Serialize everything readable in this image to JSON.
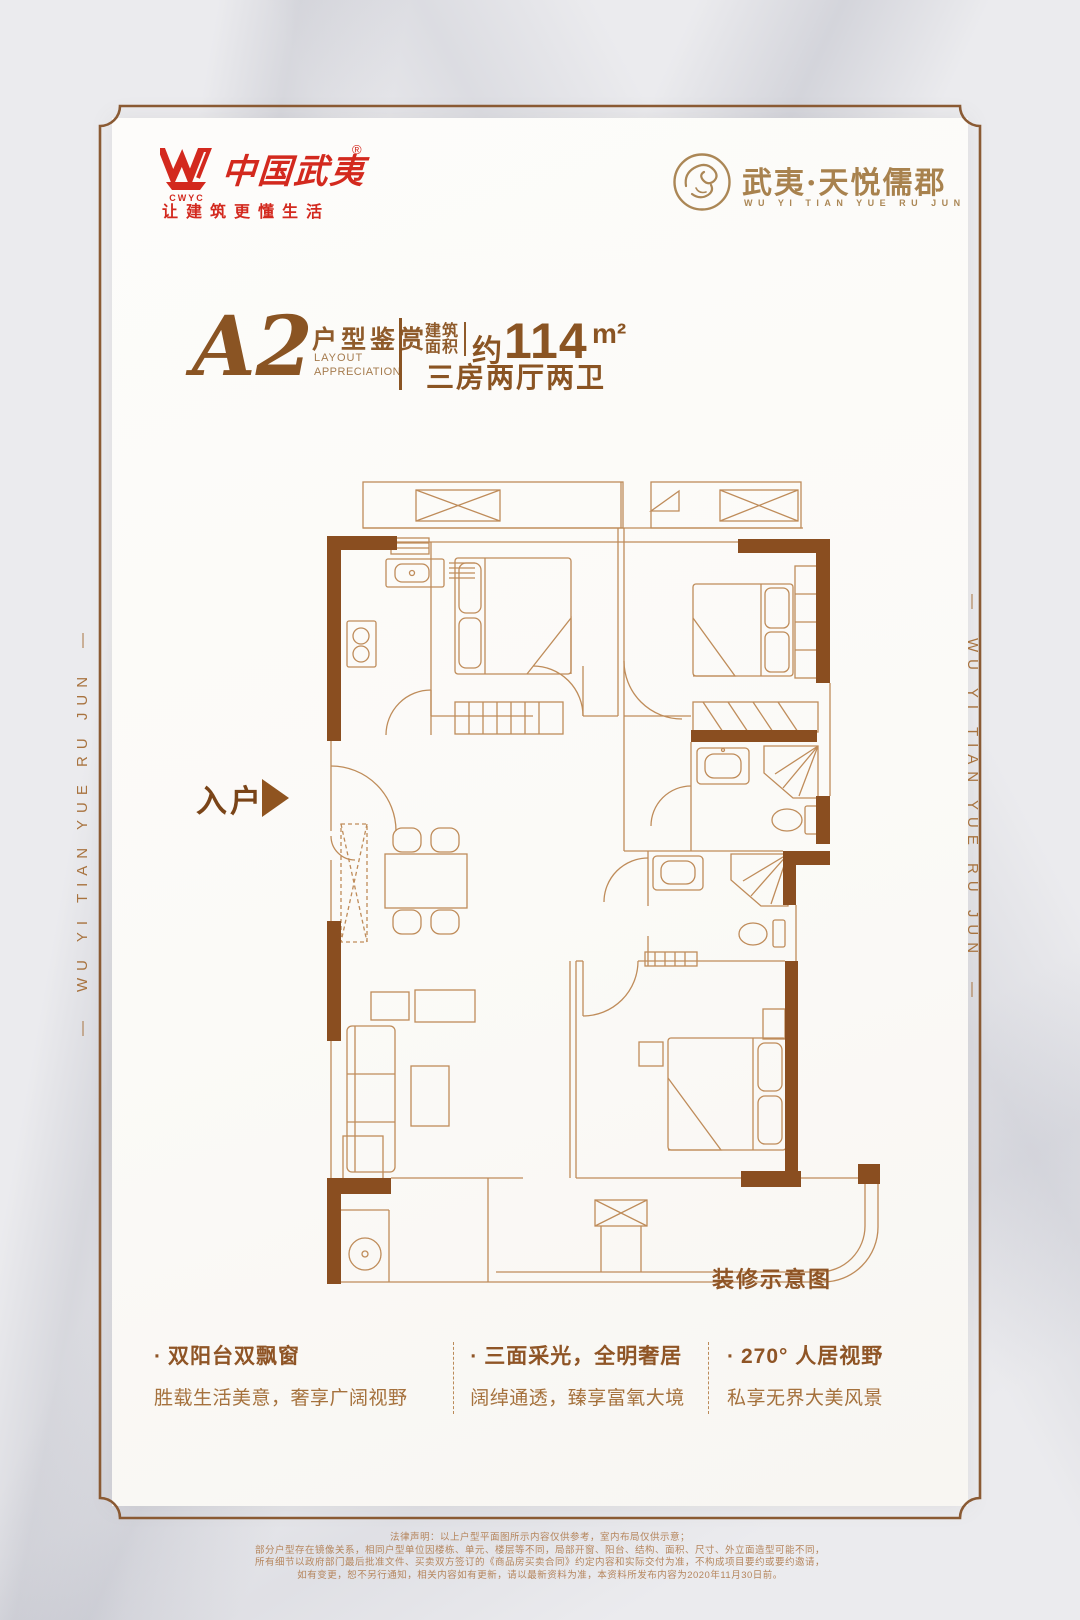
{
  "brand": {
    "logo_cn": "中国武夷",
    "logo_sub": "CWYC",
    "reg": "®",
    "tagline": "让建筑更懂生活",
    "project_name": "武夷·天悦儒郡",
    "project_name_en": "WU YI TIAN YUE RU JUN"
  },
  "side": {
    "left_text": "—　WU YI TIAN YUE RU JUN　—",
    "right_text": "—　WU YI TIAN YUE RU JUN　—"
  },
  "title": {
    "unit": "A2",
    "subtitle_cn": "户型鉴赏",
    "subtitle_en1": "LAYOUT",
    "subtitle_en2": "APPRECIATION",
    "area_label_top": "建筑",
    "area_label_bottom": "面积",
    "area_prefix": "约",
    "area_value": "114",
    "area_unit": "m²",
    "rooms": "三房两厅两卫"
  },
  "plan": {
    "entry_label": "入户",
    "caption": "装修示意图"
  },
  "features_bullet": "·",
  "features": [
    {
      "title": "双阳台双飘窗",
      "desc": "胜载生活美意，奢享广阔视野"
    },
    {
      "title": "三面采光，全明奢居",
      "desc": "阔绰通透，臻享富氧大境"
    },
    {
      "title": "270° 人居视野",
      "desc": "私享无界大美风景"
    }
  ],
  "legal": {
    "lines": [
      "法律声明：以上户型平面图所示内容仅供参考，室内布局仅供示意；",
      "部分户型存在镜像关系，相同户型单位因楼栋、单元、楼层等不同，局部开窗、阳台、结构、面积、尺寸、外立面造型可能不同，",
      "所有细节以政府部门最后批准文件、买卖双方签订的《商品房买卖合同》约定内容和实际交付为准，不构成项目要约或要约邀请，",
      "如有变更，恕不另行通知，相关内容如有更新，请以最新资料为准，本资料所发布内容为2020年11月30日前。"
    ]
  },
  "colors": {
    "brand_red": "#d3291e",
    "gold": "#a8824e",
    "title_brown": "#8a5423",
    "wall_brown": "#8a4e20",
    "line_brown": "#bf8c5a"
  }
}
